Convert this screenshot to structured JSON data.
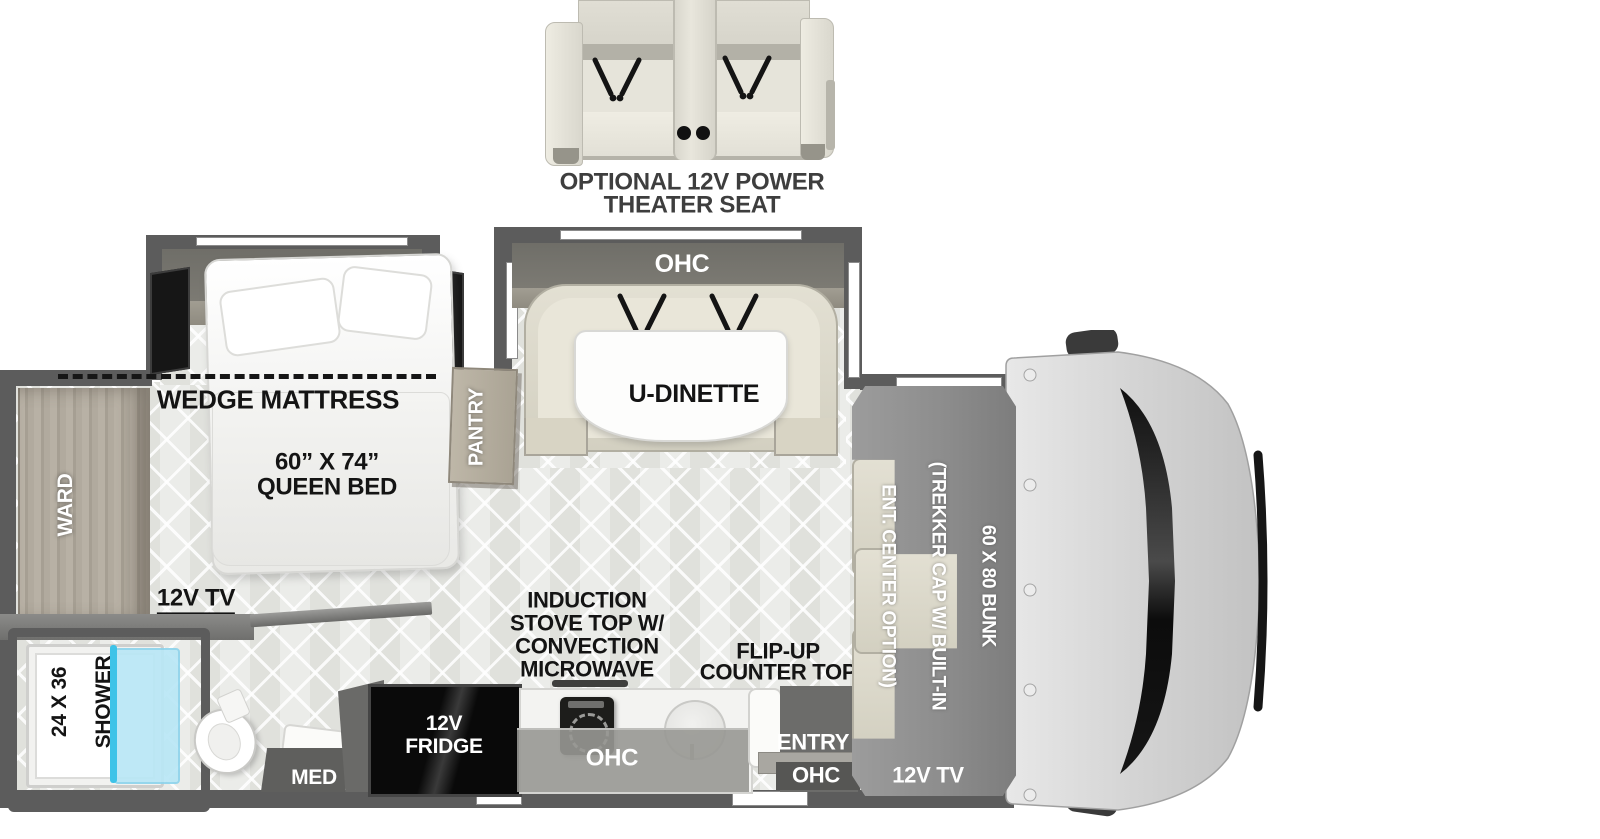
{
  "theater_seat": {
    "label_line1": "OPTIONAL 12V POWER",
    "label_line2": "THEATER SEAT"
  },
  "bedroom": {
    "ohc": "OHC",
    "wedge_mattress": "WEDGE MATTRESS",
    "bed_size": "60” X 74”",
    "bed_type": "QUEEN BED",
    "tv": "12V TV",
    "ward": "WARD"
  },
  "pantry": {
    "label": "PANTRY"
  },
  "bathroom": {
    "shower_line1": "24 X 36",
    "shower_line2": "SHOWER",
    "med": "MED"
  },
  "dinette": {
    "ohc": "OHC",
    "label": "U-DINETTE"
  },
  "kitchen": {
    "stove_line1": "INDUCTION",
    "stove_line2": "STOVE TOP W/",
    "stove_line3": "CONVECTION",
    "stove_line4": "MICROWAVE",
    "fridge_line1": "12V",
    "fridge_line2": "FRIDGE",
    "ohc": "OHC",
    "flip_line1": "FLIP-UP",
    "flip_line2": "COUNTER TOP",
    "entry": "ENTRY",
    "entry_ohc": "OHC"
  },
  "bunk": {
    "line1": "60 X 80 BUNK",
    "line2": "(TREKKER CAP W/ BUILT-IN",
    "line3": "ENT. CENTER OPTION)",
    "tv": "12V TV"
  },
  "colors": {
    "wall": "#5c5c5c",
    "floor": "#e7e8e4",
    "bench_cream": "#d8d4c4",
    "bunk_gray": "#8f8f8f",
    "fridge_black": "#0b0b0b",
    "shower_glass": "#b9e7f6",
    "shower_door_accent": "#3ec3e8",
    "label_black": "#141414",
    "label_white": "#ffffff"
  }
}
